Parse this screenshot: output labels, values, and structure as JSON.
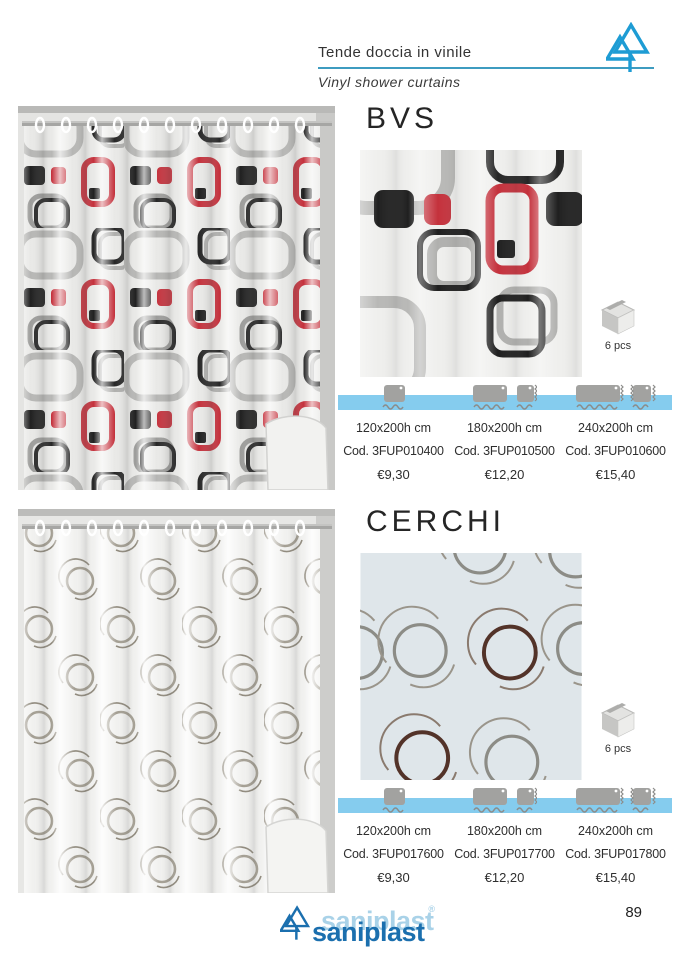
{
  "header": {
    "title_it": "Tende doccia in vinile",
    "title_en": "Vinyl shower curtains"
  },
  "products": [
    {
      "name": "BVS",
      "pack_qty": "6 pcs",
      "variants": [
        {
          "size": "120x200h cm",
          "code": "Cod. 3FUP010400",
          "price": "€9,30"
        },
        {
          "size": "180x200h cm",
          "code": "Cod. 3FUP010500",
          "price": "€12,20"
        },
        {
          "size": "240x200h cm",
          "code": "Cod. 3FUP010600",
          "price": "€15,40"
        }
      ]
    },
    {
      "name": "CERCHI",
      "pack_qty": "6 pcs",
      "variants": [
        {
          "size": "120x200h cm",
          "code": "Cod. 3FUP017600",
          "price": "€9,30"
        },
        {
          "size": "180x200h cm",
          "code": "Cod. 3FUP017700",
          "price": "€12,20"
        },
        {
          "size": "240x200h cm",
          "code": "Cod. 3FUP017800",
          "price": "€15,40"
        }
      ]
    }
  ],
  "footer": {
    "brand": "saniplast",
    "trademark": "®",
    "page_number": "89"
  },
  "colors": {
    "accent_bar": "#85CCEE",
    "header_rule": "#3E9CC0",
    "logo_cyan": "#1E9CD4",
    "brand_blue": "#1B6FAE",
    "brand_blue_light": "#A9D2E8",
    "motif_red": "#C4313C",
    "motif_black": "#202020",
    "motif_gray": "#A9A9A7"
  }
}
